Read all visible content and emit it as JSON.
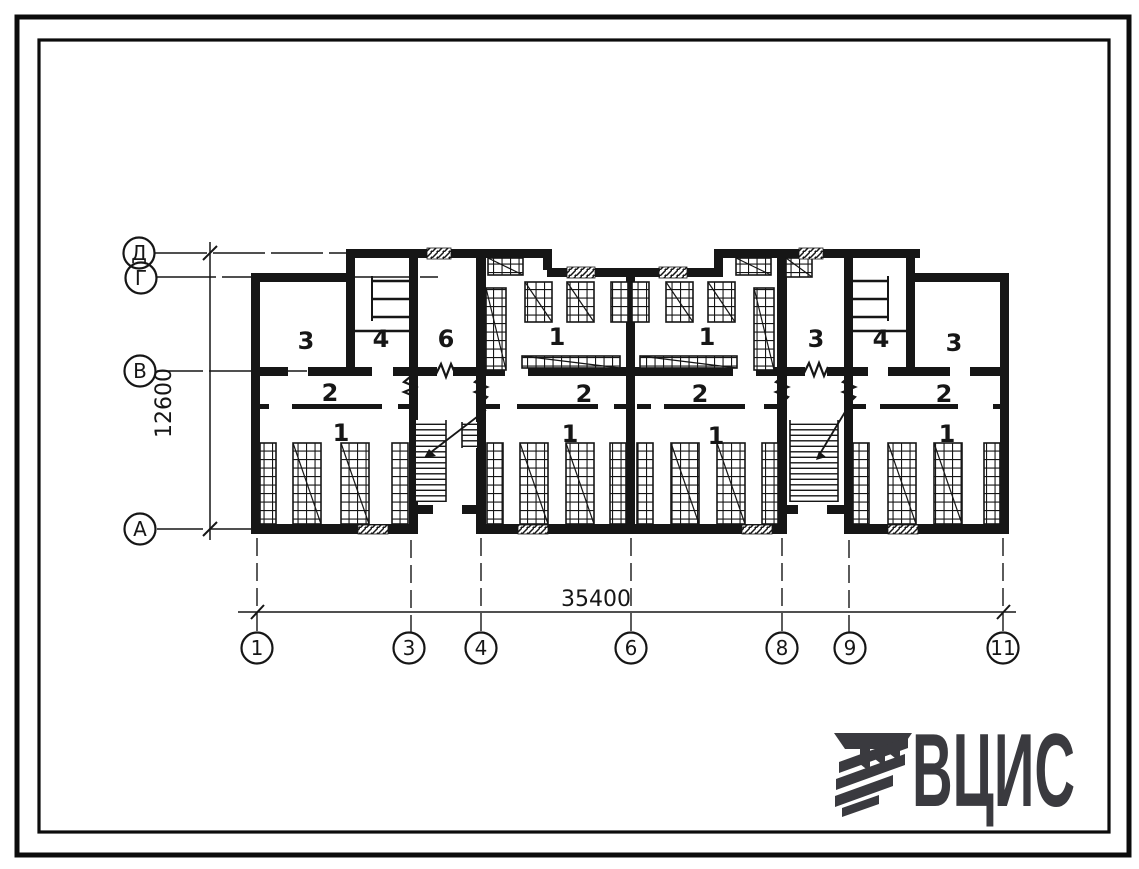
{
  "plan": {
    "rooms_top": [
      "3",
      "4",
      "6",
      "1",
      "1",
      "3",
      "4",
      "3"
    ],
    "rooms_corridor": [
      "2",
      "2",
      "2",
      "2"
    ],
    "rooms_bottom": [
      "1",
      "1",
      "1",
      "1"
    ],
    "axis_rows": [
      "Д",
      "Г",
      "В",
      "А"
    ],
    "grid_columns": [
      "1",
      "3",
      "4",
      "6",
      "8",
      "9",
      "11"
    ],
    "dim_width": "35400",
    "dim_height": "12600"
  },
  "logo": {
    "text": "ВЦИС"
  },
  "colors": {
    "ink": "#161616",
    "logo": "#3a3a3f",
    "paper": "#ffffff"
  }
}
